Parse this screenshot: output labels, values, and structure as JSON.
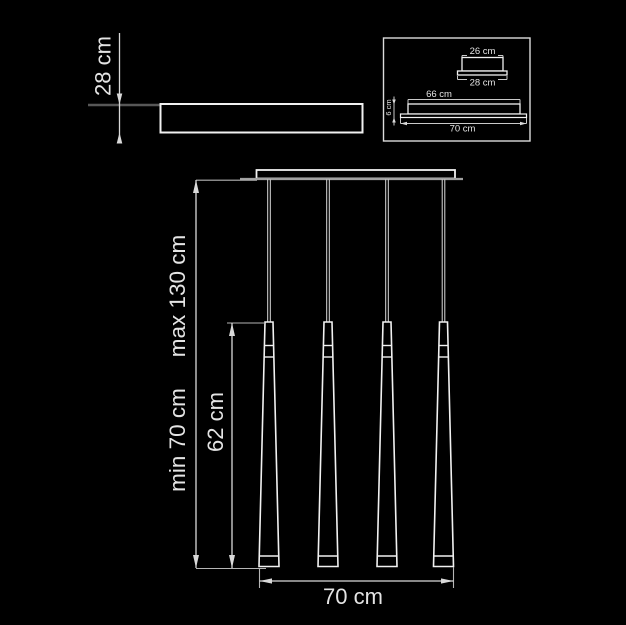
{
  "colors": {
    "background": "#000000",
    "line_bright": "#f1f1f1",
    "line_gray": "#a0a0a0",
    "line_dark_gray": "#575757",
    "dimension_line": "#d9d9d9",
    "text": "#e4e4e4"
  },
  "plan_view": {
    "height_label": "28 cm"
  },
  "detail_inset": {
    "canopy_section": {
      "top_width_label": "26 cm",
      "base_width_label": "28 cm"
    },
    "bar_section": {
      "body_width_label": "66 cm",
      "base_width_label": "70 cm",
      "height_label": "6 cm"
    }
  },
  "front_view": {
    "pendant_count": 4,
    "max_drop_label": "max 130 cm",
    "min_drop_label": "min 70 cm",
    "cone_length_label": "62 cm",
    "overall_width_label": "70 cm"
  }
}
